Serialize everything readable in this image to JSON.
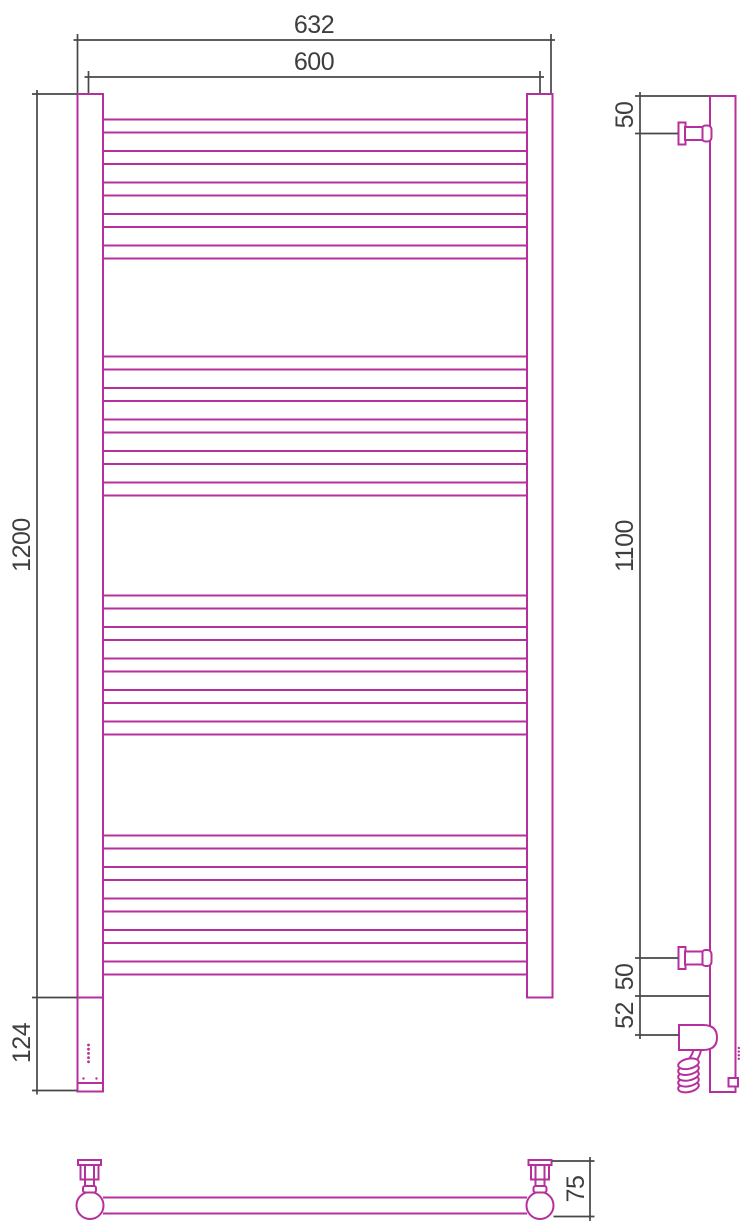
{
  "drawing": {
    "title": "heated towel rail technical drawing",
    "colors": {
      "product_outline": "#b5309c",
      "dimension_lines": "#474747",
      "background": "#ffffff"
    },
    "front_view": {
      "rail_count": 20,
      "rail_groups": 4,
      "rails_per_group": 5,
      "led_dot_count": 5,
      "foot_dot_count": 2
    },
    "side_view": {
      "bracket_count": 2,
      "cable_coil_loops": 5,
      "detail_dot_count": 4
    },
    "bottom_view": {
      "bracket_count": 2
    },
    "dimensions": {
      "overall_width": "632",
      "center_width": "600",
      "overall_height": "1200",
      "lower_section_height": "124",
      "top_bracket_offset": "50",
      "bracket_span": "1100",
      "bottom_bracket_offset": "50",
      "heater_offset": "52",
      "wall_depth": "75"
    }
  }
}
